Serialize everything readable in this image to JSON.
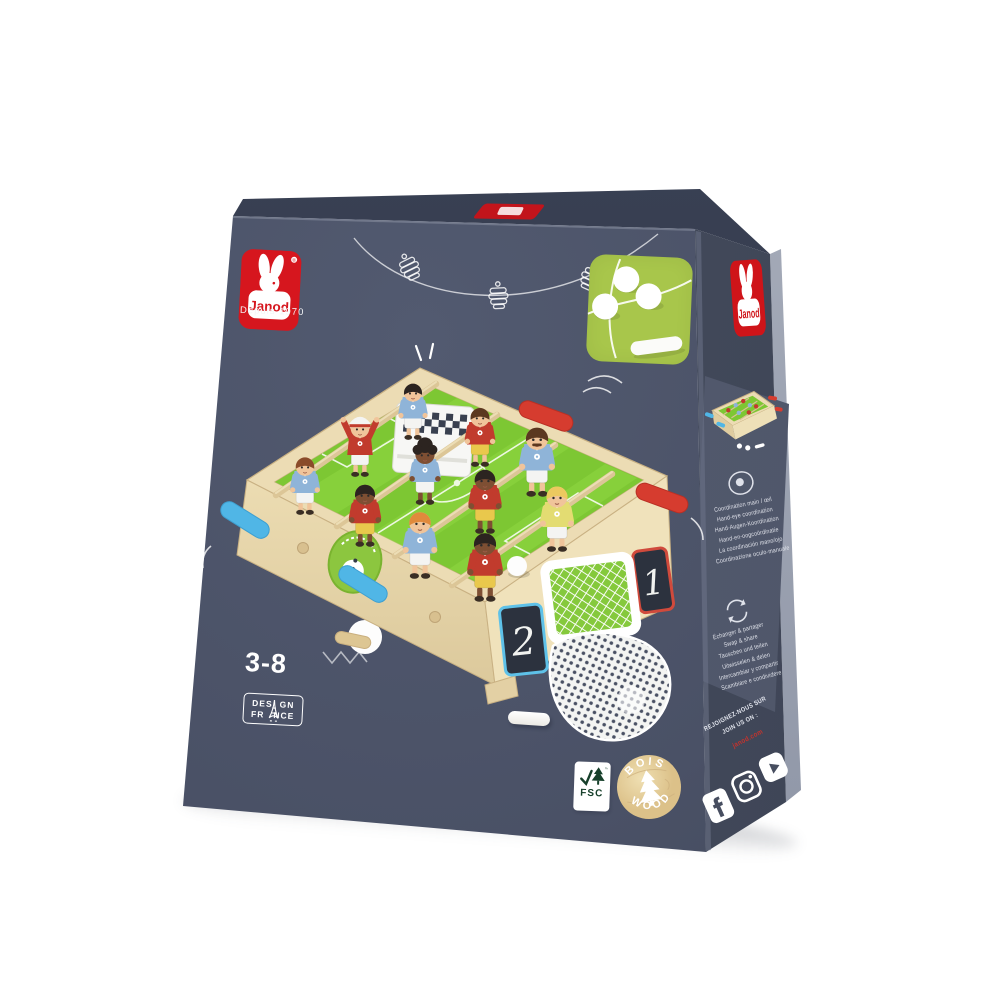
{
  "brand": {
    "name": "Janod",
    "tagline": "Depuis 1970",
    "registered": "®"
  },
  "badges": {
    "age_range": "3-8",
    "design": {
      "line1_left": "DES",
      "line1_right": "GN",
      "line2_left": "FR",
      "line2_right": "NCE"
    },
    "fsc": {
      "acronym": "FSC",
      "tm": "™"
    },
    "wood": {
      "arc_top": "BOIS",
      "arc_bottom": "WOOD"
    }
  },
  "scoreboard": {
    "left": "2",
    "right": "1"
  },
  "side_panel": {
    "features": [
      {
        "icon": "hand-eye-icon",
        "lines": [
          "Coordination main / œil",
          "Hand-eye coordination",
          "Hand-Augen-Koordination",
          "Hand-en-oogcoördinatie",
          "La coordinación mano/ojo",
          "Coordinazione oculo-manuale"
        ]
      },
      {
        "icon": "swap-share-icon",
        "lines": [
          "Échanger & partager",
          "Swap & share",
          "Tauschen und teilen",
          "Uitwisselen & delen",
          "Intercambiar y compartir",
          "Scambiare e condividere"
        ]
      }
    ],
    "join_us": {
      "line1": "REJOIGNEZ-NOUS SUR",
      "line2": "JOIN US ON :",
      "website": "janod.com"
    },
    "social": [
      {
        "name": "facebook"
      },
      {
        "name": "instagram"
      },
      {
        "name": "youtube"
      }
    ]
  },
  "colors": {
    "janod_red": "#d6161e",
    "box_slate": "#4b5166",
    "accent_green": "#a8c64b",
    "field_green": "#7dc733",
    "wood": "#ecdcb4",
    "handle_blue": "#50b6e6",
    "handle_red": "#d63c2f"
  }
}
